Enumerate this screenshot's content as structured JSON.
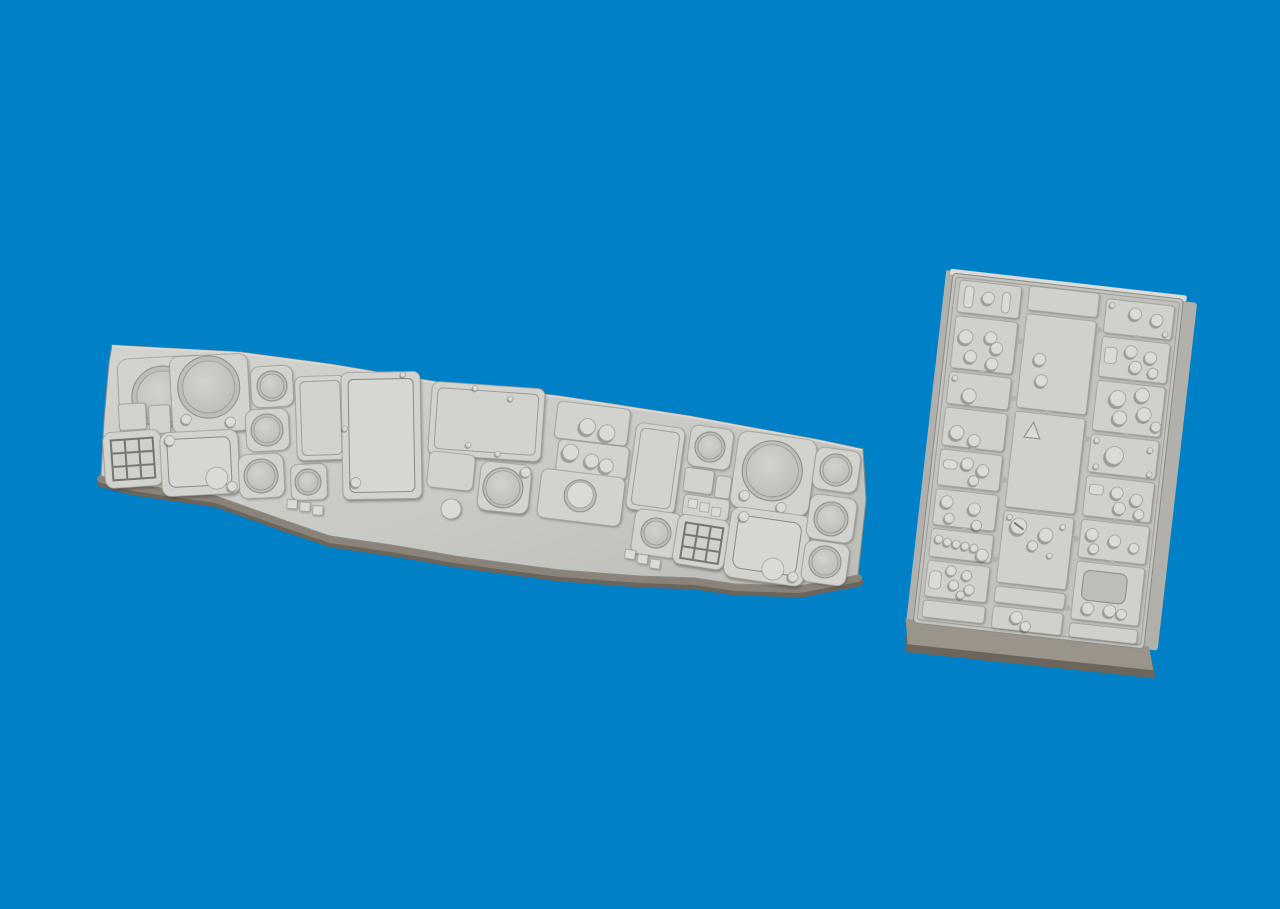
{
  "image": {
    "type": "3d-product-render",
    "subject": "Two grey cast resin scale-model cockpit parts photographed on a plain blue background",
    "parts": [
      {
        "id": "main-instrument-panel",
        "description": "Long angled instrument panel with round gauge bezels, rectangular display screens, keypads, button strips and small knobs",
        "features": [
          "round-gauge x10",
          "rect-screen x4",
          "keypad-grid x2",
          "button-strip x3",
          "small-knob x6"
        ]
      },
      {
        "id": "center-console",
        "description": "Rectangular console plate, slightly rotated, with three columns of small sub-panels fitted with cylindrical knobs, slots, blank plates and a triangle marking",
        "features": [
          "sub-panel-columns x3",
          "cylindrical-knob clusters",
          "triangle-mark x1",
          "edge-notches"
        ]
      }
    ]
  },
  "palette": {
    "background": "#0080C7",
    "slab_light": "#d3d3cf",
    "slab_mid": "#c9c9c5",
    "slab_dark": "#bdbdb8",
    "sub_panel": "#d0d0cc",
    "raised": "#d2d2ce",
    "raised_light": "#dadad6",
    "screen_face": "#d6d6d2",
    "recess": "#bebeb9",
    "gauge_center": "#d2d2ce",
    "gauge_edge": "#bcbcb6",
    "edge_line": "#9e9e99",
    "edge_dark": "#8b8b85",
    "grid_line": "#77766f",
    "underside": "#8a8379",
    "underside_dark": "#6b655c",
    "side_wall": "#b2b0ab",
    "bottom_wall": "#9a948b",
    "channel": "#c2c2be",
    "notch": "#b2b2ad",
    "lip": "#dddcd8"
  }
}
